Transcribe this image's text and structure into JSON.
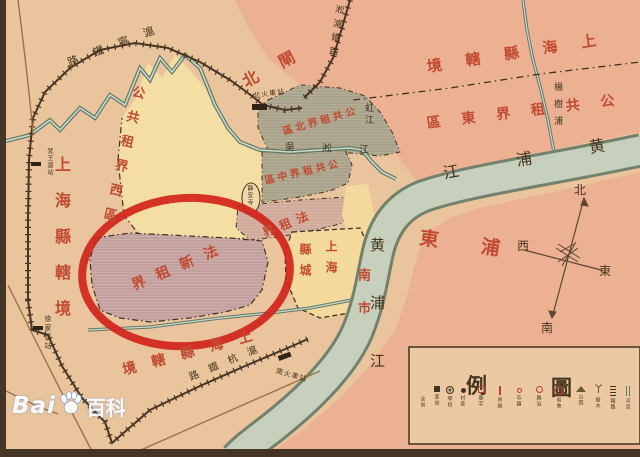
{
  "labels": {
    "county_left": "上海縣轄境",
    "county_top_right": "境轄縣海上",
    "settlement_east": "區東界租共公",
    "zhabei": "北閘",
    "settlement_west": "公共租界西區",
    "french_new": "界租新法",
    "french_concession": "界租法",
    "settlement_central": "區中界租共公",
    "settlement_north": "區北界租共公",
    "county_bottom": "境轄縣海上",
    "pudong": "東浦",
    "nanshi": "南市",
    "county_city_right_col": "上海",
    "county_city_left_col": "縣城",
    "huangpu_upper": "江浦黄",
    "huangpu_south": "黄浦江",
    "wusong_river": "吳淞江",
    "yangshupu": "楊樹浦",
    "hongjiang": "虹江",
    "jingan_temple": "靜安寺",
    "north_station": "北火車站",
    "south_station": "南火車站",
    "xujiahui_station": "徐家匯站",
    "fanwangdu_station": "梵王渡站",
    "huning_railway": "路鐵寧滬",
    "songhu_railway": "淞滬鐵路",
    "huhang_railway": "路鐵杭滬"
  },
  "compass": {
    "north": "北",
    "west": "西",
    "east": "東",
    "south": "南"
  },
  "legend": {
    "title_left": "例",
    "title_right": "圖",
    "items": [
      {
        "symbol": "none",
        "label": "全省"
      },
      {
        "symbol": "sq-black",
        "label": "車站"
      },
      {
        "symbol": "ring-double",
        "label": "學校"
      },
      {
        "symbol": "dot-black",
        "label": "村莊"
      },
      {
        "symbol": "sq-red",
        "label": "廟宇"
      },
      {
        "symbol": "bar-red",
        "label": "界線"
      },
      {
        "symbol": "ring-red-sm",
        "label": "市鎮"
      },
      {
        "symbol": "ring-red",
        "label": "縣治"
      },
      {
        "symbol": "ring-red-lg",
        "label": "省會"
      },
      {
        "symbol": "hill",
        "label": "山岡"
      },
      {
        "symbol": "tree",
        "label": "樹木"
      },
      {
        "symbol": "rail",
        "label": "鐵路"
      },
      {
        "symbol": "river",
        "label": "河流"
      }
    ],
    "tree_glyph": "丫"
  },
  "watermark": {
    "brand": "Bai",
    "suffix": "百科"
  },
  "colors": {
    "paper": "#e9c49d",
    "salmon_east": "#ecab90",
    "yellow_settlement": "#f4dea4",
    "yellow_city": "#f4d99c",
    "grey_settlement": "#b5ae96",
    "lilac_french_new": "#cdacaa",
    "pink_french_strip": "#d8b2a4",
    "river_fill": "#c6d0bd",
    "river_edge": "#72816b",
    "railway": "#463522",
    "red_text": "#c14b32",
    "annotation_circle": "#d0241b"
  }
}
